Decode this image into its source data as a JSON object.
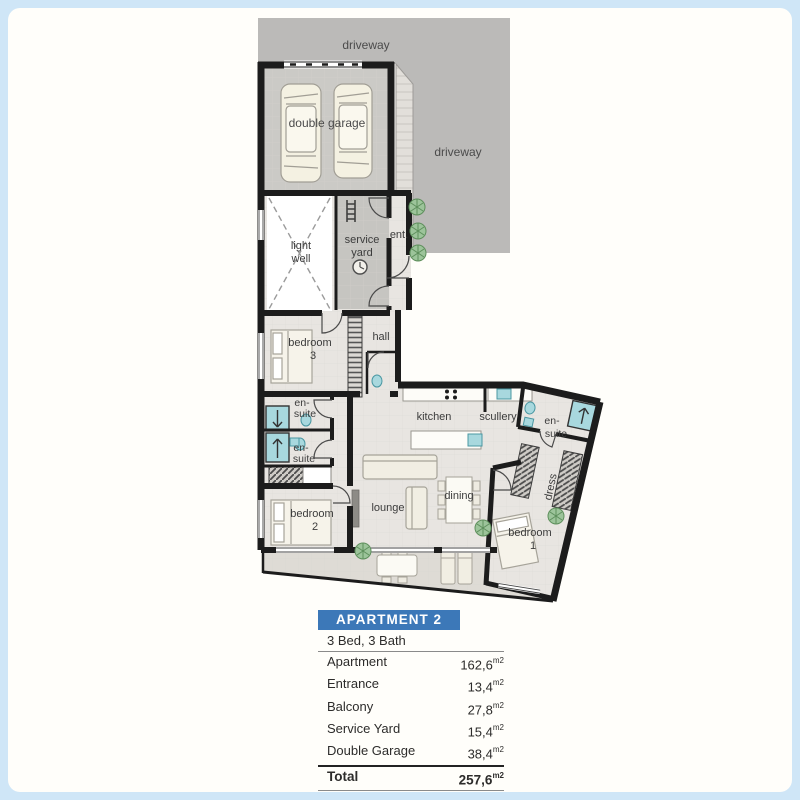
{
  "plan": {
    "labels": {
      "driveway_top": "driveway",
      "driveway_side": "driveway",
      "double_garage": "double garage",
      "light_well": [
        "light",
        "well"
      ],
      "service_yard": [
        "service",
        "yard"
      ],
      "entrance": "ent.",
      "hall": "hall",
      "bedroom_3": [
        "bedroom",
        "3"
      ],
      "ensuite_bed3": [
        "en-",
        "suite"
      ],
      "ensuite_bed2": [
        "en-",
        "suite"
      ],
      "kitchen": "kitchen",
      "scullery": "scullery",
      "lounge": "lounge",
      "dining": "dining",
      "ensuite_bed1": [
        "en-",
        "suite"
      ],
      "dress": "dress",
      "bedroom_2": [
        "bedroom",
        "2"
      ],
      "bedroom_1": [
        "bedroom",
        "1"
      ]
    }
  },
  "summary": {
    "title": "APARTMENT 2",
    "subtitle": "3 Bed, 3 Bath",
    "unit": "m2",
    "rows": [
      {
        "label": "Apartment",
        "value": "162,6"
      },
      {
        "label": "Entrance",
        "value": "13,4"
      },
      {
        "label": "Balcony",
        "value": "27,8"
      },
      {
        "label": "Service Yard",
        "value": "15,4"
      },
      {
        "label": "Double Garage",
        "value": "38,4"
      }
    ],
    "total": {
      "label": "Total",
      "value": "257,6"
    }
  },
  "colors": {
    "header_blue": "#3c78b8",
    "driveway_gray": "#bbbab8",
    "garage_floor_gray": "#cbcac6",
    "apartment_floor": "#e8e5e1",
    "balcony_floor": "#dedbd5",
    "shower_cyan": "#a8d8de",
    "wall_black": "#1c1c1c",
    "plant_green": "#8fbe8c"
  }
}
